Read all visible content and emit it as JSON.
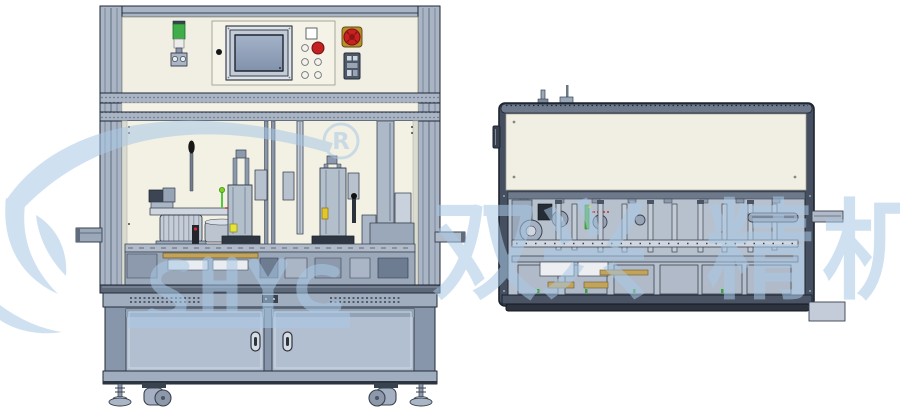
{
  "scene": {
    "registered_symbol": "R",
    "watermark_characters": [
      "双",
      "兴",
      "精",
      "机"
    ],
    "watermark_color": "#a9c9e6"
  },
  "left_machine": {
    "label": "assembly-machine-front-view",
    "control_panel": {
      "tower_light_color": "#3fae4a",
      "start_button_color": "#c42222",
      "estop_button_color": "#cc2020",
      "screen_color": "#93a2ba"
    },
    "cabinet_door_handle_count": "2"
  },
  "right_machine": {
    "label": "assembly-module-side-view",
    "panel_color": "#f1efe3",
    "frame_color": "#454f60"
  }
}
